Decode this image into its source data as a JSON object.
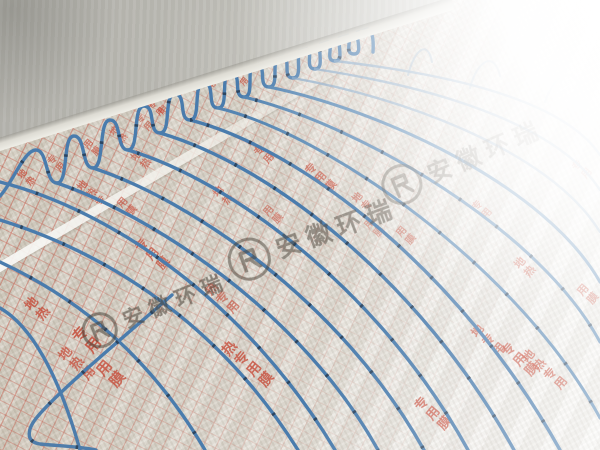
{
  "scene": {
    "type": "photograph",
    "subject": "Blue hydronic underfloor-heating pipe laid in serpentine loops on silver reflective insulation foil",
    "background": "Bare grey concrete wall at upper left, bright window glare washing out the upper right"
  },
  "palette": {
    "pipe_blue": "#4a7cad",
    "pipe_clip_dark": "#273c54",
    "foil_near": "#d6d0c4",
    "foil_far": "#f7f6f3",
    "grid_red": "#c65242",
    "print_red": "#c64532",
    "wall_grey": "#bdbcb5",
    "watermark_grey": "#4a4238"
  },
  "foil_print": {
    "full_text": "地热专用膜",
    "meaning_note_visible": "",
    "color": "#c64532"
  },
  "watermark": {
    "text": "安徽环瑞",
    "logo": "circled stylized monogram"
  },
  "watermarks": [
    {
      "cx": 101,
      "cy": 337,
      "fs": 21,
      "opacity": 0.55,
      "rot": -22
    },
    {
      "cx": 250,
      "cy": 266,
      "fs": 25,
      "opacity": 0.5,
      "rot": -20
    },
    {
      "cx": 403,
      "cy": 192,
      "fs": 24,
      "opacity": 0.42,
      "rot": -23
    }
  ],
  "stamps": [
    {
      "text": "专用",
      "x": 146,
      "y": 106,
      "size": 8,
      "opacity": 0.7
    },
    {
      "text": "用",
      "x": 205,
      "y": 86,
      "size": 8,
      "opacity": 0.6
    },
    {
      "text": "专用",
      "x": 230,
      "y": 76,
      "size": 8,
      "opacity": 0.6
    },
    {
      "text": "用",
      "x": 255,
      "y": 67,
      "size": 8,
      "opacity": 0.55
    },
    {
      "text": "专",
      "x": 278,
      "y": 59,
      "size": 8,
      "opacity": 0.5
    },
    {
      "text": "用",
      "x": 300,
      "y": 51,
      "size": 8,
      "opacity": 0.5
    },
    {
      "text": "专",
      "x": 321,
      "y": 44,
      "size": 7,
      "opacity": 0.45
    },
    {
      "text": "用",
      "x": 341,
      "y": 38,
      "size": 7,
      "opacity": 0.4
    },
    {
      "text": "地热",
      "x": 14,
      "y": 176,
      "size": 9,
      "opacity": 0.7
    },
    {
      "text": "专用",
      "x": 44,
      "y": 162,
      "size": 9,
      "opacity": 0.65
    },
    {
      "text": "用膜",
      "x": 80,
      "y": 146,
      "size": 9,
      "opacity": 0.6
    },
    {
      "text": "地热",
      "x": 106,
      "y": 133,
      "size": 9,
      "opacity": 0.6
    },
    {
      "text": "专用",
      "x": 132,
      "y": 121,
      "size": 9,
      "opacity": 0.55
    },
    {
      "text": "用",
      "x": 155,
      "y": 112,
      "size": 9,
      "opacity": 0.5
    },
    {
      "text": "地热",
      "x": 127,
      "y": 158,
      "size": 10,
      "opacity": 0.6
    },
    {
      "text": "专用",
      "x": 250,
      "y": 153,
      "size": 10,
      "opacity": 0.6
    },
    {
      "text": "专用膜",
      "x": 302,
      "y": 170,
      "size": 11,
      "opacity": 0.65
    },
    {
      "text": "地热",
      "x": 209,
      "y": 194,
      "size": 10,
      "opacity": 0.6
    },
    {
      "text": "用膜",
      "x": 259,
      "y": 213,
      "size": 10,
      "opacity": 0.5
    },
    {
      "text": "地热专",
      "x": 73,
      "y": 188,
      "size": 10,
      "opacity": 0.65
    },
    {
      "text": "用膜",
      "x": 113,
      "y": 205,
      "size": 10,
      "opacity": 0.6
    },
    {
      "text": "专用膜",
      "x": 132,
      "y": 246,
      "size": 12,
      "opacity": 0.7
    },
    {
      "text": "热专用",
      "x": 202,
      "y": 290,
      "size": 12,
      "opacity": 0.6
    },
    {
      "text": "地专",
      "x": 348,
      "y": 200,
      "size": 10,
      "opacity": 0.5
    },
    {
      "text": "用膜",
      "x": 392,
      "y": 234,
      "size": 10,
      "opacity": 0.5
    },
    {
      "text": "专用",
      "x": 468,
      "y": 208,
      "size": 10,
      "opacity": 0.45
    },
    {
      "text": "地热",
      "x": 20,
      "y": 306,
      "size": 13,
      "opacity": 0.75
    },
    {
      "text": "专用",
      "x": 68,
      "y": 336,
      "size": 15,
      "opacity": 0.8
    },
    {
      "text": "用膜",
      "x": 92,
      "y": 370,
      "size": 15,
      "opacity": 0.75
    },
    {
      "text": "地热用",
      "x": 54,
      "y": 356,
      "size": 13,
      "opacity": 0.7
    },
    {
      "text": "热专用膜",
      "x": 218,
      "y": 350,
      "size": 14,
      "opacity": 0.75
    },
    {
      "text": "专用膜",
      "x": 410,
      "y": 406,
      "size": 13,
      "opacity": 0.7
    },
    {
      "text": "地专用",
      "x": 468,
      "y": 332,
      "size": 12,
      "opacity": 0.65
    },
    {
      "text": "专用膜",
      "x": 497,
      "y": 352,
      "size": 13,
      "opacity": 0.7
    },
    {
      "text": "地热",
      "x": 511,
      "y": 264,
      "size": 11,
      "opacity": 0.6
    },
    {
      "text": "用膜",
      "x": 574,
      "y": 291,
      "size": 11,
      "opacity": 0.6
    },
    {
      "text": "专用",
      "x": 568,
      "y": 168,
      "size": 10,
      "opacity": 0.45
    },
    {
      "text": "地热专用",
      "x": 519,
      "y": 357,
      "size": 12,
      "opacity": 0.7
    },
    {
      "text": "用膜",
      "x": 360,
      "y": 226,
      "size": 10,
      "opacity": 0.4
    }
  ]
}
